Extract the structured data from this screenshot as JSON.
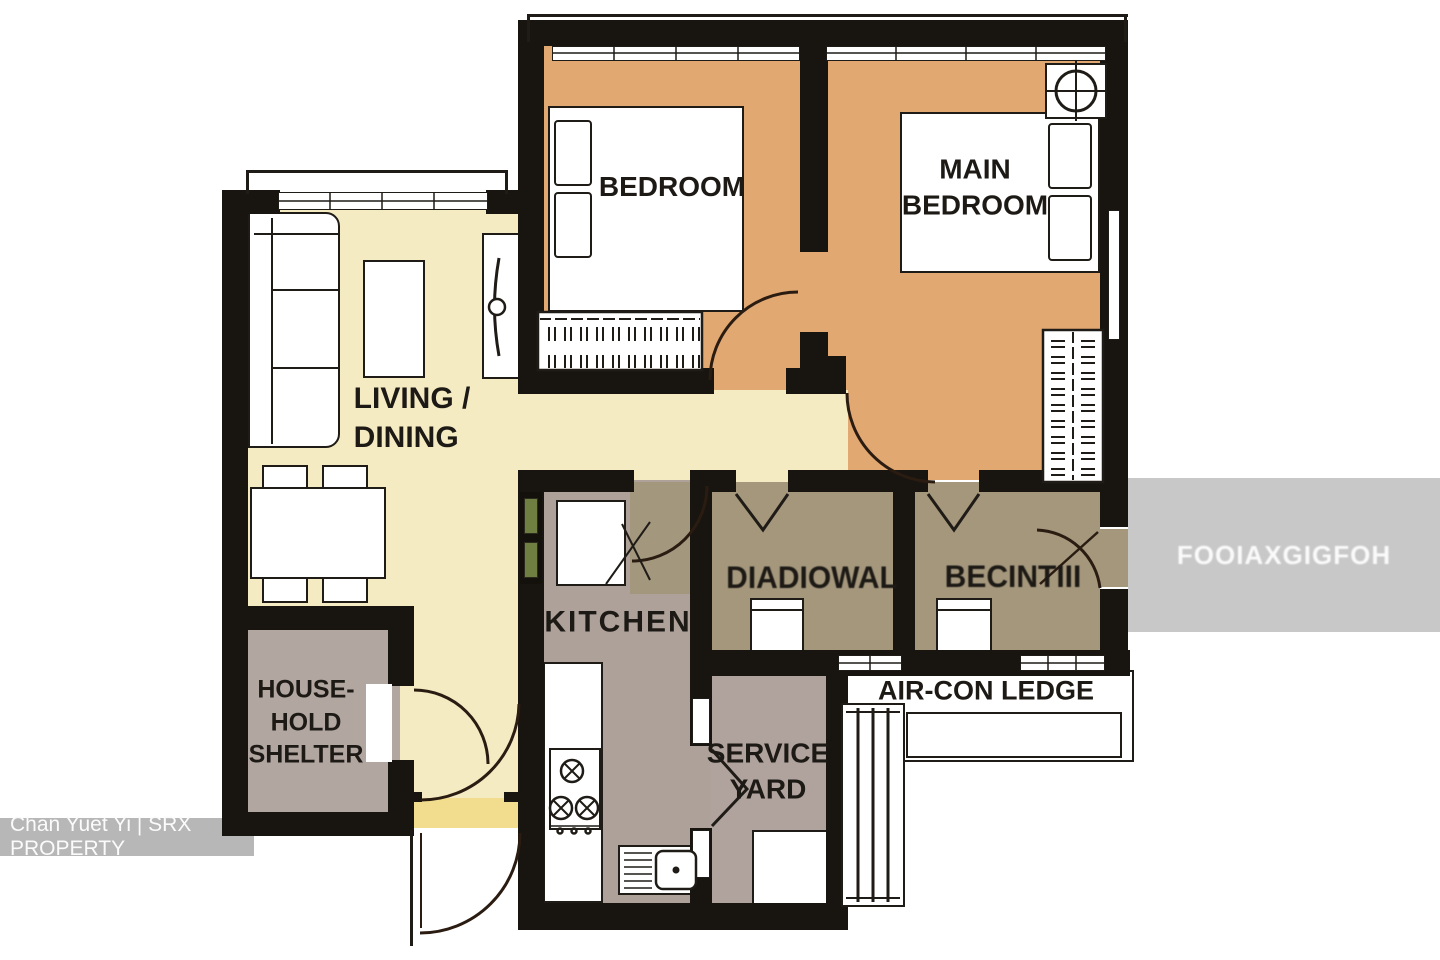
{
  "rooms": {
    "bedroom": {
      "label": "BEDROOM"
    },
    "main_bedroom": {
      "line1": "MAIN",
      "line2": "BEDROOM"
    },
    "living_dining": {
      "line1": "LIVING /",
      "line2": "DINING"
    },
    "kitchen": {
      "label": "KITCHEN"
    },
    "bath1": {
      "label": "DIADIOWAL"
    },
    "bath2": {
      "label": "BECINTIII"
    },
    "household_shelter": {
      "line1": "HOUSE-",
      "line2": "HOLD",
      "line3": "SHELTER"
    },
    "service_yard": {
      "line1": "SERVICE",
      "line2": "YARD"
    },
    "aircon_ledge": {
      "label": "AIR-CON LEDGE"
    }
  },
  "watermarks": {
    "agent_credit": "Chan Yuet Yi | SRX PROPERTY",
    "right_box_text": "FOOIAXGIGFOH"
  },
  "colors": {
    "bedroom_floor": "#e2a872",
    "living_floor": "#f4ebc3",
    "threshold": "#f1dd8d",
    "kitchen_floor": "#aea19a",
    "kitchen_khaki": "#a3977e",
    "bath_floor": "#a4977c",
    "shelter_floor": "#b2a6a1",
    "service_yard_floor": "#b0a29c",
    "wall": "#181410",
    "watermark_gray": "#c8c8c8"
  }
}
